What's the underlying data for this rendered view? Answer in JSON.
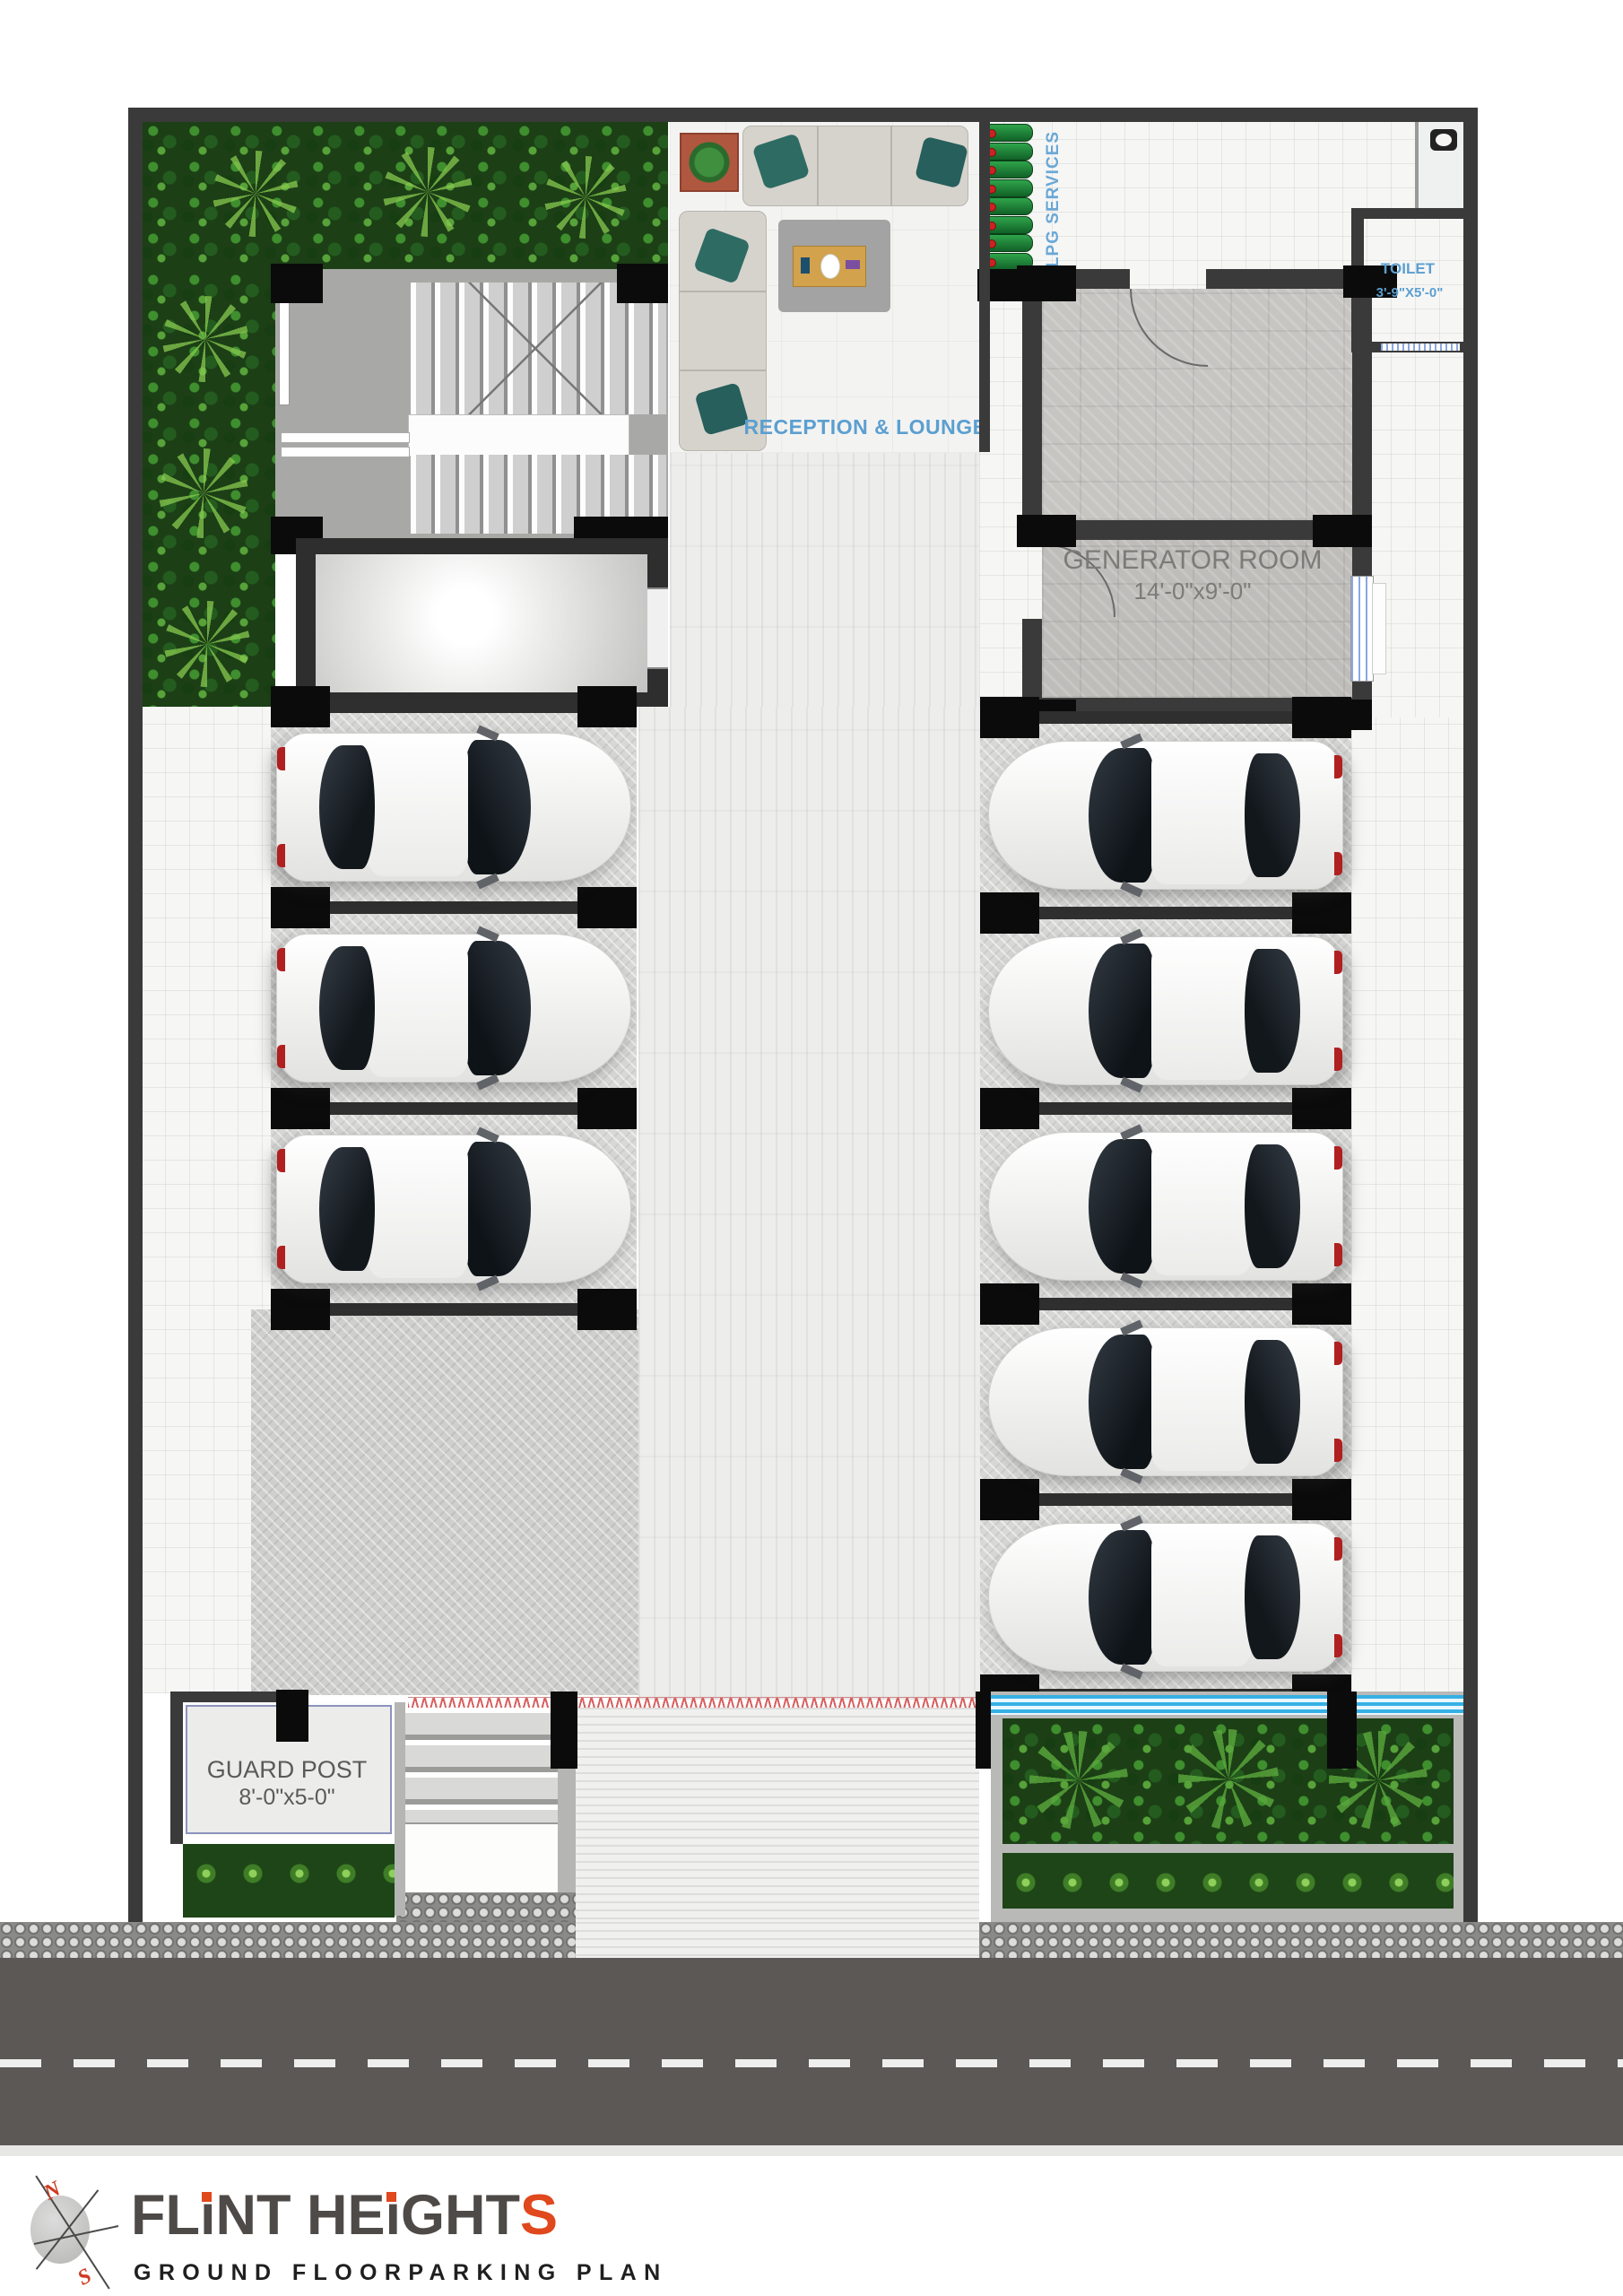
{
  "branding": {
    "title_full": "FLINT HEIGHTS",
    "title_parts": {
      "a": "FL",
      "i1": "ı",
      "b": "NT HE",
      "i2": "ı",
      "c": "GHT",
      "s": "S"
    },
    "subtitle": "GROUND FLOORPARKING PLAN",
    "compass": {
      "north": "N",
      "south": "S"
    }
  },
  "rooms": {
    "reception": {
      "label": "RECEPTION & LOUNGE"
    },
    "generator": {
      "label": "GENERATOR ROOM",
      "size": "14'-0\"x9'-0\""
    },
    "toilet": {
      "label": "TOILET",
      "size": "3'-9\"X5'-0\""
    },
    "lpg": {
      "label": "LPG SERVICES",
      "cylinder_count": 8
    },
    "guard_post": {
      "label": "GUARD POST",
      "size": "8'-0\"x5-0\""
    }
  },
  "parking": {
    "columns": [
      {
        "side": "left",
        "car_count": 3,
        "facing": "right"
      },
      {
        "side": "right",
        "car_count": 5,
        "facing": "left"
      }
    ],
    "total_cars": 8
  },
  "colors": {
    "label_blue": "#5b9fd0",
    "label_gray": "#7b7b78",
    "wall": "#3a3a3a",
    "column_black": "#0b0b0b",
    "accent_orange": "#e0481d",
    "road": "#5c5855",
    "water_blue": "#3fb6e8",
    "cylinder_green": "#2fa44b",
    "plant_dark_green": "#1c3f16",
    "car_white": "#f4f4f3"
  }
}
